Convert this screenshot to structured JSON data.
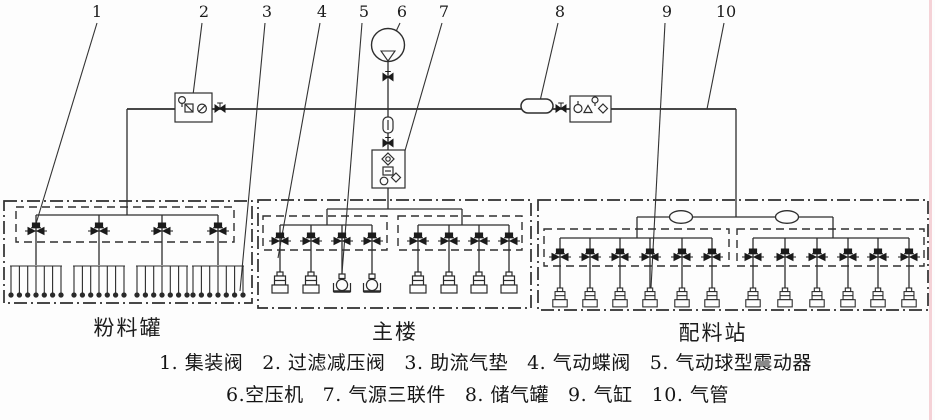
{
  "callouts": [
    "1",
    "2",
    "3",
    "4",
    "5",
    "6",
    "7",
    "8",
    "9",
    "10"
  ],
  "sections": {
    "powder_tank": {
      "label": "粉料罐",
      "collecting_valve_count": 4,
      "air_cushion_count": 4
    },
    "main_building": {
      "label": "主楼",
      "butterfly_valve_count": 8,
      "air_cylinder_count": 6,
      "ball_vibrator_count": 2
    },
    "batching_station": {
      "label": "配料站",
      "butterfly_valve_count": 12,
      "air_cylinder_count": 12,
      "inline_tank_count": 2
    }
  },
  "legend": {
    "row1": [
      {
        "text": "1. 集装阀"
      },
      {
        "text": "2. 过滤减压阀"
      },
      {
        "text": "3. 助流气垫"
      },
      {
        "text": "4. 气动蝶阀"
      },
      {
        "text": "5. 气动球型震动器"
      }
    ],
    "row2": [
      {
        "text": "6.空压机"
      },
      {
        "text": "7. 气源三联件"
      },
      {
        "text": "8. 储气罐"
      },
      {
        "text": "9. 气缸"
      },
      {
        "text": "10. 气管"
      }
    ]
  },
  "colors": {
    "line": "#2e2e2e",
    "glyph": "#1b1b1b",
    "background": "#fdfdfd",
    "right_edge_mark": "#f3cad0"
  }
}
